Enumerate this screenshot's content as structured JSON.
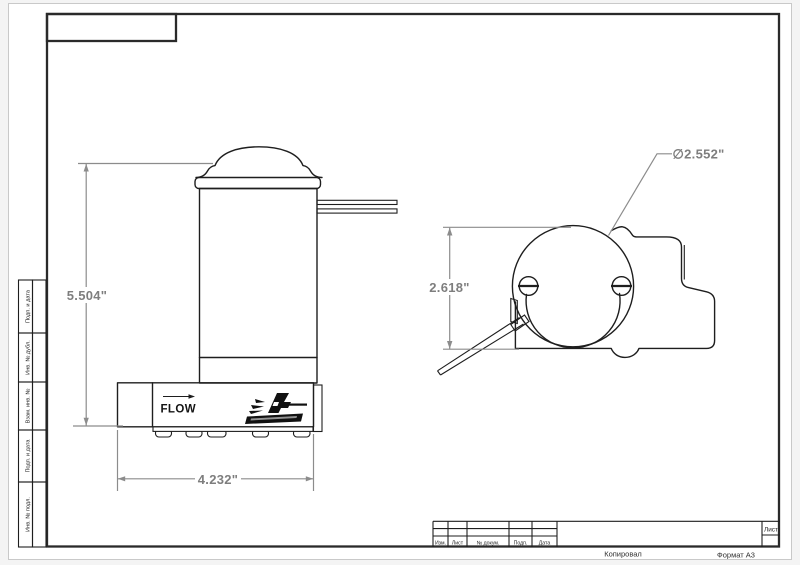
{
  "dimensions": {
    "side_height": "5.504\"",
    "side_width": "4.232\"",
    "top_height": "2.618\"",
    "top_diameter": "∅2.552\""
  },
  "pump": {
    "flow_label": "FLOW",
    "logo_icon": "aeromotive-logo"
  },
  "sidebar": {
    "items": [
      {
        "label": "Подп. и дата"
      },
      {
        "label": "Инв. № дубл."
      },
      {
        "label": "Взам. инв. №"
      },
      {
        "label": "Подп. и дата"
      },
      {
        "label": "Инв. № подл."
      }
    ]
  },
  "title_block": {
    "columns": [
      "Изм.",
      "Лист",
      "№ докум.",
      "Подп.",
      "Дата"
    ],
    "sheet_label": "Лист",
    "copied_label": "Копировал",
    "format_label": "Формат А3"
  },
  "colors": {
    "line": "#1e1e1e",
    "dimension": "#8c8c8c",
    "paper": "#ffffff"
  }
}
